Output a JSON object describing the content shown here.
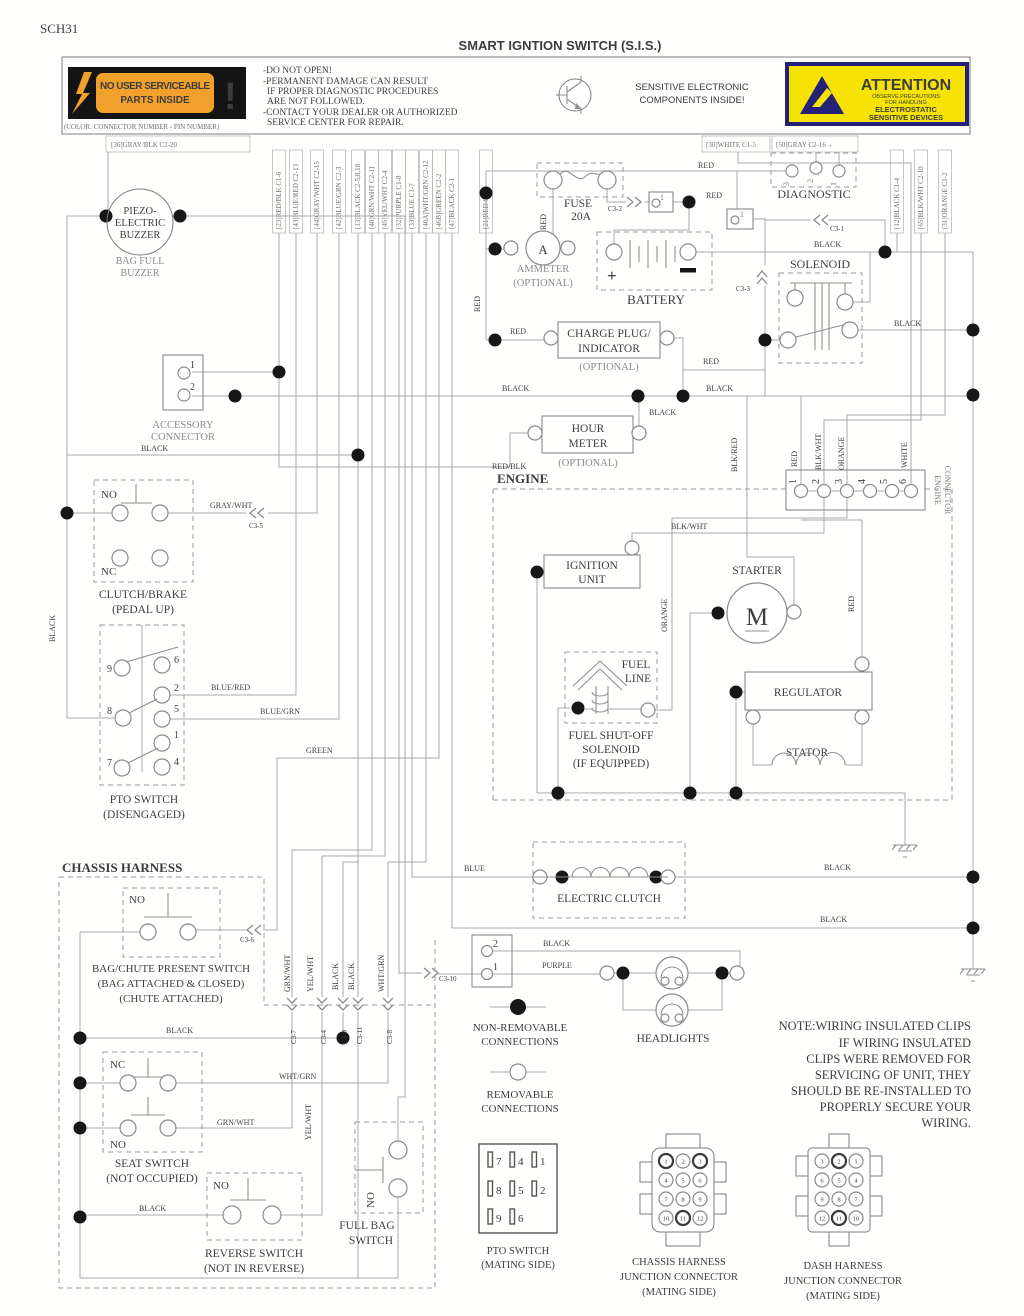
{
  "colors": {
    "warn_orange": "#f2a02c",
    "attention_yellow": "#f6e303",
    "attention_navy": "#232178",
    "label_black": "#141414"
  },
  "h": {
    "sheet_id": "SCH31",
    "title": "SMART IGNTION SWITCH (S.I.S.)",
    "no_user_1": "NO USER SERVICEABLE",
    "no_user_2": "PARTS INSIDE",
    "exclaim": "!",
    "color_note": "(COLOR: CONNECTOR NUMBER - PIN NUMBER)",
    "warn_lines": [
      "-DO NOT OPEN!",
      "-PERMANENT DAMAGE CAN RESULT",
      "IF PROPER DIAGNOSTIC PROCEDURES",
      "ARE NOT FOLLOWED.",
      "-CONTACT YOUR DEALER OR AUTHORIZED",
      "SERVICE CENTER FOR REPAIR."
    ],
    "sensitive_1": "SENSITIVE ELECTRONIC",
    "sensitive_2": "COMPONENTS INSIDE!",
    "attention": {
      "title": "ATTENTION",
      "l1": "OBSERVE PRECAUTIONS",
      "l2": "FOR HANDLING",
      "l3": "ELECTROSTATIC",
      "l4": "SENSITIVE DEVICES"
    }
  },
  "cols": {
    "c36": "[36]GRAY/BLK C2-20",
    "c30": "[30]WHITE C1-5",
    "c50": "[50]GRAY C2-16→",
    "left": [
      "[23]RED/BLK C1-6",
      "[43]BLUE/RED C2-13",
      "[44]GRAY/WHT C2-15",
      "[42]BLUE/GRN C2-3",
      "[13]BLACK C2-5,8,18",
      "[40]GRN/WHT C2-11",
      "[45]YEL/WHT C2-4",
      "[32]PURPLE C1-8",
      "[33]BLUE C1-7",
      "[40A]WHT/GRN C2-12",
      "[46B]GREEN C2-2",
      "[47]BLACK C2-1",
      "[21]RED C1-1"
    ],
    "right": [
      "[12]BLACK C1-4",
      "[65]BLK/WHT C2-10",
      "[31]ORANGE C1-2"
    ]
  },
  "wl": [
    "RED",
    "RED",
    "RED",
    "BLACK",
    "RED",
    "BLACK",
    "RED",
    "RED",
    "BLACK",
    "BLACK",
    "BLACK",
    "RED/BLK",
    "BLK/RED",
    "GRAY/WHT",
    "BLACK",
    "BLACK",
    "RED",
    "BLK/WHT",
    "ORANGE",
    "WHITE",
    "BLK/WHT",
    "ORANGE",
    "RED",
    "BLUE/RED",
    "BLUE/GRN",
    "GREEN",
    "BLUE",
    "BLACK",
    "BLACK",
    "BLACK",
    "PURPLE",
    "GRN/WHT",
    "YEL/WHT",
    "BLACK",
    "BLACK",
    "WHT/GRN",
    "BLACK",
    "WHT/GRN",
    "GRN/WHT",
    "YEL/WHT",
    "BLACK"
  ],
  "refs": [
    "C3-2",
    "C3-1",
    "C3-3",
    "C3-5",
    "C3-6",
    "C3-7",
    "C3-4",
    "C3-9",
    "C3-11",
    "C3-8",
    "C3-10"
  ],
  "cp": {
    "buzzer": {
      "l1": "PIEZO-",
      "l2": "ELECTRIC",
      "l3": "BUZZER",
      "cap1": "BAG FULL",
      "cap2": "BUZZER"
    },
    "fuse": {
      "l1": "FUSE",
      "l2": "20A"
    },
    "ammeter": {
      "sym": "A",
      "cap1": "AMMETER",
      "cap2": "(OPTIONAL)"
    },
    "battery": {
      "label": "BATTERY",
      "plus": "+"
    },
    "diagnostic": {
      "label": "DIAGNOSTIC",
      "pins": [
        "3",
        "2",
        "1"
      ]
    },
    "solenoid": {
      "label": "SOLENOID"
    },
    "charge": {
      "l1": "CHARGE PLUG/",
      "l2": "INDICATOR",
      "opt": "(OPTIONAL)"
    },
    "hour": {
      "l1": "HOUR",
      "l2": "METER",
      "opt": "(OPTIONAL)"
    },
    "accessory": {
      "p1": "1",
      "p2": "2",
      "cap1": "ACCESSORY",
      "cap2": "CONNECTOR"
    },
    "clutch_brake": {
      "no": "NO",
      "nc": "NC",
      "cap1": "CLUTCH/BRAKE",
      "cap2": "(PEDAL UP)"
    },
    "pto": {
      "pins": [
        "9",
        "6",
        "2",
        "8",
        "5",
        "1",
        "7",
        "4"
      ],
      "cap1": "PTO SWITCH",
      "cap2": "(DISENGAGED)"
    },
    "engine": {
      "label": "ENGINE"
    },
    "engine_conn": {
      "pins": [
        "1",
        "2",
        "3",
        "4",
        "5",
        "6"
      ],
      "cap1": "ENGINE",
      "cap2": "CONNECTOR"
    },
    "pin_boxes": {
      "a": "1",
      "b": "1"
    },
    "ignition": {
      "l1": "IGNITION",
      "l2": "UNIT"
    },
    "starter": {
      "label": "STARTER",
      "sym": "M"
    },
    "fuel_line": {
      "l1": "FUEL",
      "l2": "LINE"
    },
    "fuel_shutoff": {
      "l1": "FUEL SHUT-OFF",
      "l2": "SOLENOID",
      "l3": "(IF EQUIPPED)"
    },
    "regulator": {
      "label": "REGULATOR"
    },
    "stator": {
      "label": "STATOR"
    },
    "chassis": {
      "label": "CHASSIS HARNESS"
    },
    "bag_chute": {
      "no": "NO",
      "cap1": "BAG/CHUTE PRESENT SWITCH",
      "cap2": "(BAG ATTACHED & CLOSED)",
      "cap3": "(CHUTE ATTACHED)"
    },
    "eclutch": {
      "label": "ELECTRIC CLUTCH"
    },
    "lightconn": {
      "p2": "2",
      "p1": "1"
    },
    "headlights": {
      "label": "HEADLIGHTS"
    },
    "seat": {
      "nc": "NC",
      "no": "NO",
      "cap1": "SEAT SWITCH",
      "cap2": "(NOT OCCUPIED)"
    },
    "reverse": {
      "no": "NO",
      "cap1": "REVERSE SWITCH",
      "cap2": "(NOT IN REVERSE)"
    },
    "fullbag": {
      "no": "NO",
      "cap1": "FULL BAG",
      "cap2": "SWITCH"
    }
  },
  "lg": {
    "nr1": "NON-REMOVABLE",
    "nr2": "CONNECTIONS",
    "r1": "REMOVABLE",
    "r2": "CONNECTIONS"
  },
  "note": [
    "NOTE:WIRING INSULATED CLIPS",
    "IF WIRING INSULATED",
    "CLIPS WERE REMOVED FOR",
    "SERVICING OF UNIT, THEY",
    "SHOULD BE RE-INSTALLED TO",
    "PROPERLY SECURE YOUR",
    "WIRING."
  ],
  "mt": {
    "pto": {
      "pins": [
        "7",
        "4",
        "1",
        "8",
        "5",
        "2",
        "9",
        "6"
      ],
      "cap1": "PTO SWITCH",
      "cap2": "(MATING SIDE)"
    },
    "chassis": {
      "pins": [
        "1",
        "2",
        "3",
        "4",
        "5",
        "6",
        "7",
        "8",
        "9",
        "10",
        "11",
        "12"
      ],
      "cap1": "CHASSIS HARNESS",
      "cap2": "JUNCTION CONNECTOR",
      "cap3": "(MATING SIDE)"
    },
    "dash": {
      "pins": [
        "3",
        "2",
        "1",
        "6",
        "5",
        "4",
        "9",
        "8",
        "7",
        "12",
        "11",
        "10"
      ],
      "cap1": "DASH HARNESS",
      "cap2": "JUNCTION CONNECTOR",
      "cap3": "(MATING SIDE)"
    }
  }
}
